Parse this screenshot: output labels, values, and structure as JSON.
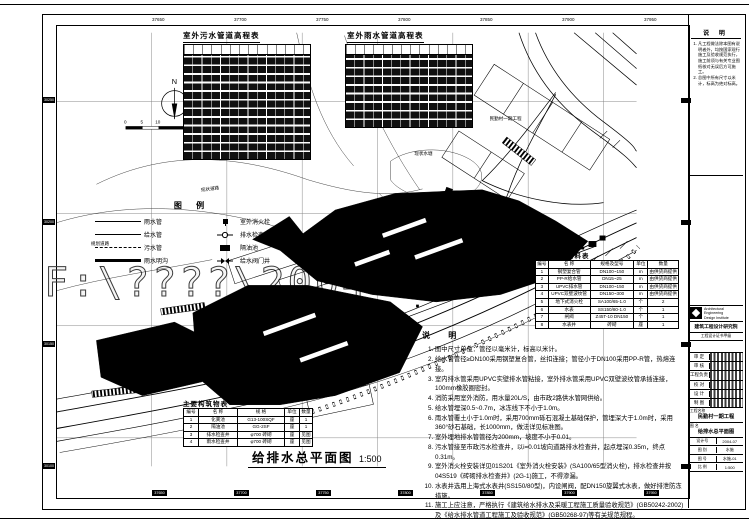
{
  "sheet": {
    "watermark": "F:\\????\\2004",
    "top_ticks": [
      "37650",
      "37700",
      "37750",
      "37800",
      "37850",
      "37900",
      "37950"
    ],
    "bottom_ticks": [
      "37650",
      "37700",
      "37750",
      "37800",
      "37850",
      "37900",
      "37950"
    ],
    "left_ticks": [
      "30250",
      "30200",
      "30150",
      "30100"
    ]
  },
  "compass": {
    "label": "N"
  },
  "scalebar": {
    "labels": [
      "0",
      "5",
      "10",
      "25M"
    ]
  },
  "elev_tables": {
    "sewage_title": "室外污水管道高程表",
    "rain_title": "室外雨水管道高程表"
  },
  "legend": {
    "title": "图  例",
    "left": [
      {
        "label": "雨水管"
      },
      {
        "label": "给水管"
      },
      {
        "label": "污水管"
      },
      {
        "label": "雨水明沟"
      }
    ],
    "right": [
      {
        "label": "室外消火栓"
      },
      {
        "label": "排水检查井"
      },
      {
        "label": "隔油池"
      },
      {
        "label": "给水阀门井"
      }
    ]
  },
  "materials": {
    "title": "主要设备材料表",
    "headers": [
      "编号",
      "名  称",
      "规格及型号",
      "单位",
      "数量"
    ],
    "rows": [
      [
        "1",
        "钢塑复合管",
        "DN100~150",
        "m",
        "由供货商提供"
      ],
      [
        "2",
        "PP-R给水管",
        "DN15~25",
        "m",
        "由供货商提供"
      ],
      [
        "3",
        "UPVC排水管",
        "DN100~150",
        "m",
        "由供货商提供"
      ],
      [
        "4",
        "UPVC双壁波纹管",
        "DN150~300",
        "m",
        "由供货商提供"
      ],
      [
        "5",
        "地下式消火栓",
        "SA100/65-1.0",
        "个",
        "2"
      ],
      [
        "6",
        "水表",
        "SS150/80-1.0",
        "个",
        "1"
      ],
      [
        "7",
        "闸阀",
        "Z45T-10 DN150",
        "个",
        "1"
      ],
      [
        "8",
        "水表井",
        "砖砌",
        "座",
        "1"
      ]
    ]
  },
  "structures": {
    "title": "主要构筑物表",
    "headers": [
      "编号",
      "名  称",
      "规  格",
      "单位",
      "数量"
    ],
    "rows": [
      [
        "1",
        "化粪池",
        "G13-100SQF",
        "座",
        "1"
      ],
      [
        "2",
        "隔油池",
        "GG-2SF",
        "座",
        "1"
      ],
      [
        "3",
        "排水检查井",
        "φ700 砖砌",
        "座",
        "见图"
      ],
      [
        "4",
        "雨水检查井",
        "φ700 砖砌",
        "座",
        "见图"
      ]
    ]
  },
  "notes": {
    "title": "说  明",
    "items": [
      "图中尺寸单位：管径以毫米计，标高以米计。",
      "给水管管径≥DN100采用钢塑复合管，丝扣连接；管径小于DN100采用PP-R管，热熔连接。",
      "室内排水管采用UPVC实壁排水管粘接，室外排水管采用UPVC双壁波纹管承插连接，100mm橡胶圈密封。",
      "消防采用室外消防，用水量20L/S，由市政2路供水管网供给。",
      "给水管埋深0.5~0.7m，冰冻线下不小于1.0m。",
      "雨水管覆土小于1.0m时，采用700mm砾石混凝土基础保护，管埋深大于1.0m时，采用360°砂石基础，长1000mm，做法详见标准图。",
      "室外埋地排水管管径为200mm，坡度不小于0.01。",
      "污水管接至市政污水检查井，以i=0.01坡向道路排水检查井，起点埋深0.35m，终点0.31m。",
      "室外消火栓安装详见01S201《室外消火栓安装》(SA100/65型消火栓)，排水检查井按04S519《砖砌排水检查井》(2G-1)施工，不得渗漏。",
      "水表井选用上海式水表井(SS150/80型)，内设闸阀，配DN150旋翼式水表，做好排泄防冻措施。",
      "施工上应注意，严格执行《建筑给水排水及采暖工程施工质量验收规范》(GB50242-2002)及《给水排水管道工程施工及验收规范》(GB50268-97)等有关规范规程。"
    ]
  },
  "plan": {
    "title": "给排水总平面图",
    "scale": "1:500",
    "labels": [
      {
        "text": "民勤村一期工程"
      },
      {
        "text": "现状道路"
      },
      {
        "text": "规划道路"
      },
      {
        "text": "现状水塘"
      },
      {
        "text": "雨水明沟"
      },
      {
        "text": "接市政给水管"
      },
      {
        "text": "W DN200 i=0.01"
      },
      {
        "text": "Y DN300 i=0.01"
      }
    ]
  },
  "titleblock": {
    "notes_title": "说  明",
    "notes": [
      "凡工程做法除本图有说明者外，均按国家现行施工及验收规范执行，施工前须与有关专业图纸核对无误后方可施工。",
      "总图中所有尺寸以米计，标高为绝对标高。"
    ],
    "company_en1": "Architectural Engineering",
    "company_en2": "Design Institute",
    "company": "建筑工程设计研究院",
    "cert": "工程设计证书甲级",
    "sign_rows": [
      {
        "label": "审 定"
      },
      {
        "label": "审 核"
      },
      {
        "label": "工程负责"
      },
      {
        "label": "校 对"
      },
      {
        "label": "设 计"
      },
      {
        "label": "制 图"
      }
    ],
    "project_label": "工程名称",
    "project": "民勤村一期工程",
    "drawing_label": "图 名",
    "drawing": "给排水总平面图",
    "meta": [
      {
        "c1": "设计号",
        "c2": "2004-07"
      },
      {
        "c1": "图 别",
        "c2": "水施"
      },
      {
        "c1": "图 号",
        "c2": "水施-01"
      },
      {
        "c1": "比 例",
        "c2": "1:500"
      }
    ]
  }
}
